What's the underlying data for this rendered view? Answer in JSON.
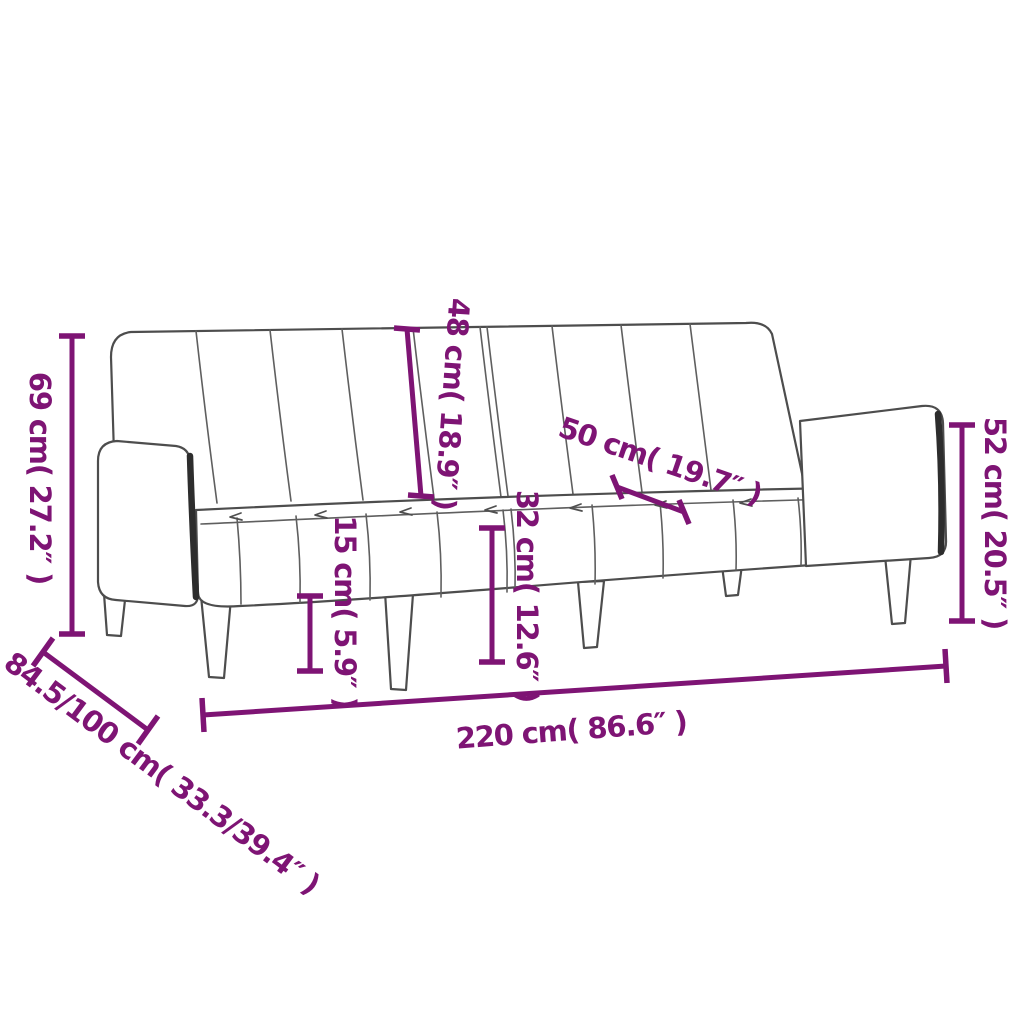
{
  "page": {
    "background": "#ffffff",
    "accent_color": "#7E1474",
    "line_color": "#4d4d4d"
  },
  "labels": {
    "total_height": "69 cm( 27.2″ )",
    "backrest_height": "48 cm( 18.9″ )",
    "seat_depth": "50 cm( 19.7″ )",
    "armrest_height": "52 cm( 20.5″ )",
    "ground_clearance": "15 cm( 5.9″ )",
    "seat_height": "32 cm( 12.6″ )",
    "total_width": "220 cm( 86.6″ )",
    "total_depth": "84.5/100 cm( 33.3/39.4″ )"
  }
}
